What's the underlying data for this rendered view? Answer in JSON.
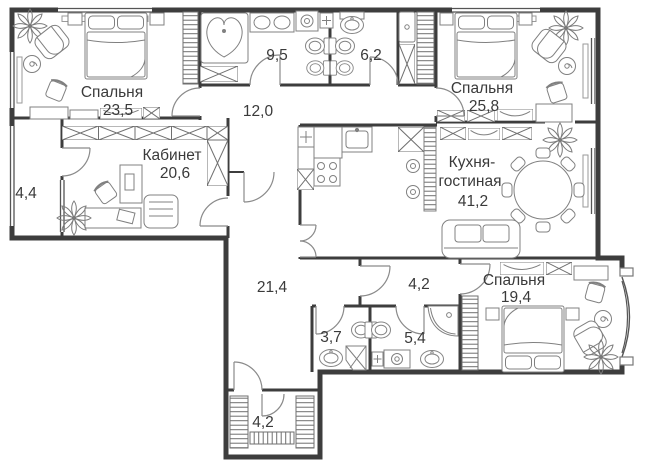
{
  "colors": {
    "wall": "#3d3d3d",
    "furniture_line": "#808080",
    "hatch": "#6f6f6f",
    "door": "#8a8a8a",
    "text": "#3a3a3a",
    "background": "#ffffff"
  },
  "rooms": {
    "bedroom1": {
      "name": "Спальня",
      "area": "23,5"
    },
    "bathroom1": {
      "area": "9,5"
    },
    "wc1": {
      "area": "6,2"
    },
    "bedroom2": {
      "name": "Спальня",
      "area": "25,8"
    },
    "hallway": {
      "area": "12,0"
    },
    "office": {
      "name": "Кабинет",
      "area": "20,6"
    },
    "balcony": {
      "area": "4,4"
    },
    "kitchen_living": {
      "name_line1": "Кухня-",
      "name_line2": "гостиная",
      "area": "41,2"
    },
    "corridor": {
      "area": "21,4"
    },
    "hall2": {
      "area": "4,2"
    },
    "wc2": {
      "area": "3,7"
    },
    "bathroom2": {
      "area": "5,4"
    },
    "bedroom3": {
      "name": "Спальня",
      "area": "19,4"
    },
    "closet": {
      "area": "4,2"
    }
  }
}
